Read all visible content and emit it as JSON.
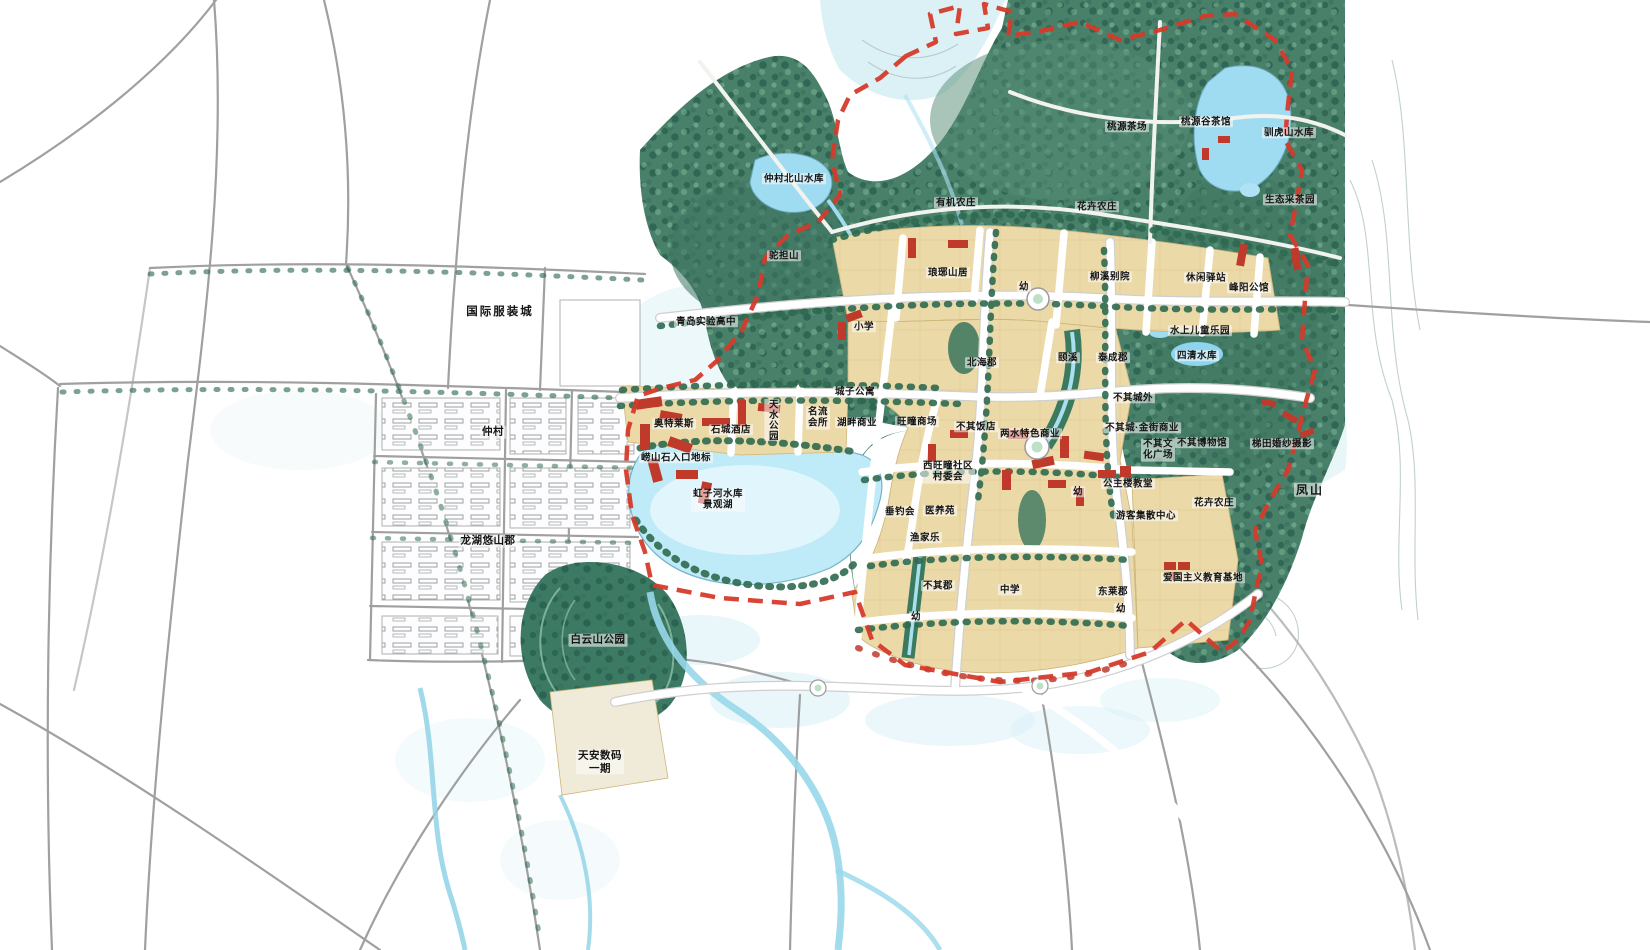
{
  "map": {
    "description": "hand-drawn watercolor urban master plan",
    "colors": {
      "forest": "#49806a",
      "forest_dark": "#2b5f4c",
      "water": "#9fdcf2",
      "water_light": "#d8eff5",
      "town_block": "#ecd9a8",
      "boundary_red": "#d63a2a",
      "accent_building": "#bf3a2b",
      "road_gray": "#a0a0a0",
      "school_pond": "#a8b7e0"
    },
    "labels": [
      {
        "text": "桃源茶场",
        "x": 1127,
        "y": 127
      },
      {
        "text": "桃源谷茶馆",
        "x": 1206,
        "y": 122
      },
      {
        "text": "驯虎山水库",
        "x": 1289,
        "y": 133
      },
      {
        "text": "生态采茶园",
        "x": 1290,
        "y": 200
      },
      {
        "text": "仲村北山水库",
        "x": 794,
        "y": 179
      },
      {
        "text": "有机农庄",
        "x": 956,
        "y": 203
      },
      {
        "text": "花卉农庄",
        "x": 1097,
        "y": 207
      },
      {
        "text": "驼担山",
        "x": 784,
        "y": 256
      },
      {
        "text": "琅琊山居",
        "x": 948,
        "y": 273
      },
      {
        "text": "幼",
        "x": 1024,
        "y": 287
      },
      {
        "text": "柳溪别院",
        "x": 1110,
        "y": 277
      },
      {
        "text": "休闲驿站",
        "x": 1206,
        "y": 278
      },
      {
        "text": "峰阳公馆",
        "x": 1249,
        "y": 288
      },
      {
        "text": "小学",
        "x": 864,
        "y": 327
      },
      {
        "text": "北海郡",
        "x": 982,
        "y": 363
      },
      {
        "text": "颐溪",
        "x": 1068,
        "y": 358
      },
      {
        "text": "泰成郡",
        "x": 1113,
        "y": 358
      },
      {
        "text": "水上儿童乐园",
        "x": 1200,
        "y": 331
      },
      {
        "text": "四清水库",
        "x": 1197,
        "y": 356
      },
      {
        "text": "国际服装城",
        "x": 500,
        "y": 313,
        "size": 11.5
      },
      {
        "text": "青岛实验高中",
        "x": 706,
        "y": 322
      },
      {
        "text": "城子公寓",
        "x": 855,
        "y": 392
      },
      {
        "text": "奥特莱斯",
        "x": 674,
        "y": 424
      },
      {
        "text": "石城酒店",
        "x": 731,
        "y": 430
      },
      {
        "text": "天水公园",
        "x": 772,
        "y": 420,
        "vertical": true
      },
      {
        "text": "名流\n会所",
        "x": 818,
        "y": 418
      },
      {
        "text": "湖畔商业",
        "x": 857,
        "y": 423
      },
      {
        "text": "旺疃商场",
        "x": 917,
        "y": 422
      },
      {
        "text": "不其饭店",
        "x": 976,
        "y": 427
      },
      {
        "text": "两水特色商业",
        "x": 1030,
        "y": 434
      },
      {
        "text": "不其城外",
        "x": 1133,
        "y": 398
      },
      {
        "text": "不其城·金街商业",
        "x": 1142,
        "y": 428
      },
      {
        "text": "不其文\n化广场",
        "x": 1158,
        "y": 450
      },
      {
        "text": "不其博物馆",
        "x": 1202,
        "y": 443
      },
      {
        "text": "梯田婚纱摄影",
        "x": 1282,
        "y": 444
      },
      {
        "text": "西旺疃社区\n村委会",
        "x": 948,
        "y": 472
      },
      {
        "text": "崂山石入口地标",
        "x": 676,
        "y": 458
      },
      {
        "text": "虹子河水库\n景观湖",
        "x": 718,
        "y": 500
      },
      {
        "text": "垂钓会",
        "x": 900,
        "y": 512
      },
      {
        "text": "医养苑",
        "x": 940,
        "y": 511
      },
      {
        "text": "渔家乐",
        "x": 925,
        "y": 538
      },
      {
        "text": "幼",
        "x": 1078,
        "y": 492
      },
      {
        "text": "公主楼教堂",
        "x": 1128,
        "y": 484
      },
      {
        "text": "游客集散中心",
        "x": 1146,
        "y": 516
      },
      {
        "text": "花卉农庄",
        "x": 1214,
        "y": 503
      },
      {
        "text": "凤山",
        "x": 1310,
        "y": 490,
        "size": 12
      },
      {
        "text": "仲村",
        "x": 493,
        "y": 432,
        "size": 10.5
      },
      {
        "text": "龙湖悠山郡",
        "x": 488,
        "y": 541,
        "size": 10.5
      },
      {
        "text": "白云山公园",
        "x": 598,
        "y": 640,
        "size": 10.5
      },
      {
        "text": "天安数码\n一期",
        "x": 600,
        "y": 762,
        "size": 10.5
      },
      {
        "text": "不其郡",
        "x": 938,
        "y": 586
      },
      {
        "text": "中学",
        "x": 1010,
        "y": 590
      },
      {
        "text": "东莱郡",
        "x": 1113,
        "y": 592
      },
      {
        "text": "幼",
        "x": 1121,
        "y": 609
      },
      {
        "text": "幼",
        "x": 916,
        "y": 617
      },
      {
        "text": "爱国主义教育基地",
        "x": 1203,
        "y": 578
      }
    ]
  }
}
